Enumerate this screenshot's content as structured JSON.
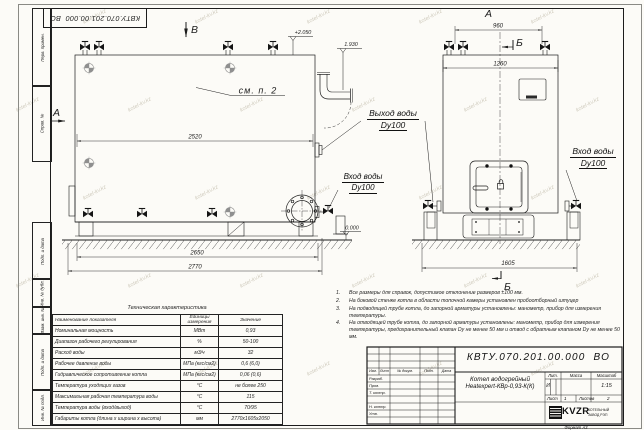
{
  "watermark": {
    "text": "kotel-kv.kz"
  },
  "frame": {
    "doc_number_top": "КВТУ.070.201.00.000  ВО",
    "left_stamps": [
      "Перв. примен.",
      "Справ. №",
      "Подп. и дата",
      "Инв. № дубл.",
      "Взам. инв. №",
      "Подп. и дата",
      "Инв. № подл."
    ],
    "format_note": "Формат А3"
  },
  "drawing": {
    "view_labels": {
      "v_top": "В",
      "a_front": "А",
      "b_front_top": "Б",
      "a_side": "А",
      "b_front_bottom": "Б"
    },
    "elevations": {
      "boiler_top": "+2.050",
      "outlet": "1.930",
      "ground": "0.000"
    },
    "dimensions": {
      "side_inner": "2520",
      "side_base": "2650",
      "side_overall": "2770",
      "front_valves": "960",
      "front_width": "1260",
      "front_base": "1605"
    },
    "callouts": {
      "see_note": "см. п. 2",
      "outlet_line1": "Выход воды",
      "outlet_line2": "Dy100",
      "inlet_left_line1": "Вход воды",
      "inlet_left_line2": "Dy100",
      "inlet_right_line1": "Вход воды",
      "inlet_right_line2": "Dy100"
    }
  },
  "notes": {
    "items": [
      {
        "num": "1.",
        "text": "Все размеры для справок, допустимое отклонение размеров ±100 мм."
      },
      {
        "num": "2.",
        "text": "На боковой стенке котла в области топочной камеры установлен пробоотборный штуцер"
      },
      {
        "num": "3.",
        "text": "На подводящей трубе котла, до запорной арматуры установлены: манометр, прибор для измерения температуры."
      },
      {
        "num": "4.",
        "text": "На отводящей трубе котла, до запорной арматуры установлены: манометр, прибор для измерения температуры, предохранительный клапан Dу не менее 50 мм и отвод с обратным клапаном Dу не менее 50 мм."
      }
    ]
  },
  "tech_table": {
    "title": "Техническая характеристика",
    "headers": {
      "name": "Наименование показателя",
      "units_1": "Единицы",
      "units_2": "измерения",
      "value": "Значение"
    },
    "rows": [
      {
        "name": "Номинальная мощность",
        "units": "МВт",
        "value": "0,93"
      },
      {
        "name": "Диапазон рабочего регулирования",
        "units": "%",
        "value": "50-100"
      },
      {
        "name": "Расход воды",
        "units": "м3/ч",
        "value": "32"
      },
      {
        "name": "Рабочее давление воды",
        "units": "МПа (кгс/см2)",
        "value": "0,6 (6,0)"
      },
      {
        "name": "Гидравлическое сопротивление котла",
        "units": "МПа (кгс/см2)",
        "value": "0,06 (0,6)"
      },
      {
        "name": "Температура уходящих газов",
        "units": "°С",
        "value": "не более 250"
      },
      {
        "name": "Максимальная рабочая температура воды",
        "units": "°С",
        "value": "115"
      },
      {
        "name": "Температура воды (вход/выход)",
        "units": "°С",
        "value": "70/95"
      },
      {
        "name": "Габариты котла (длина х ширина х высота)",
        "units": "мм",
        "value": "2770х1605х2050"
      }
    ]
  },
  "title_block": {
    "doc_number": "КВТУ.070.201.00.000  ВО",
    "product_line1": "Котел водогрейный",
    "product_line2": "Heatexpert-КВр-0,93-К(К)",
    "header_cells": [
      "Изм.",
      "Лист",
      "№ докум.",
      "Подп.",
      "Дата"
    ],
    "sign_rows": [
      "Разраб.",
      "Пров.",
      "Т. контр.",
      "Н. контр.",
      "Утв."
    ],
    "lit_label": "Лит.",
    "lit_value": "И",
    "mass_label": "Масса",
    "scale_label": "Масштаб",
    "scale_value": "1:15",
    "sheet_label": "Лист",
    "sheet_value": "1",
    "sheets_label": "Листов",
    "sheets_value": "2",
    "logo_text": "KVZR",
    "company_line1": "КОТЕЛЬНЫЙ",
    "company_line2": "ЗАВОД РЭП"
  }
}
